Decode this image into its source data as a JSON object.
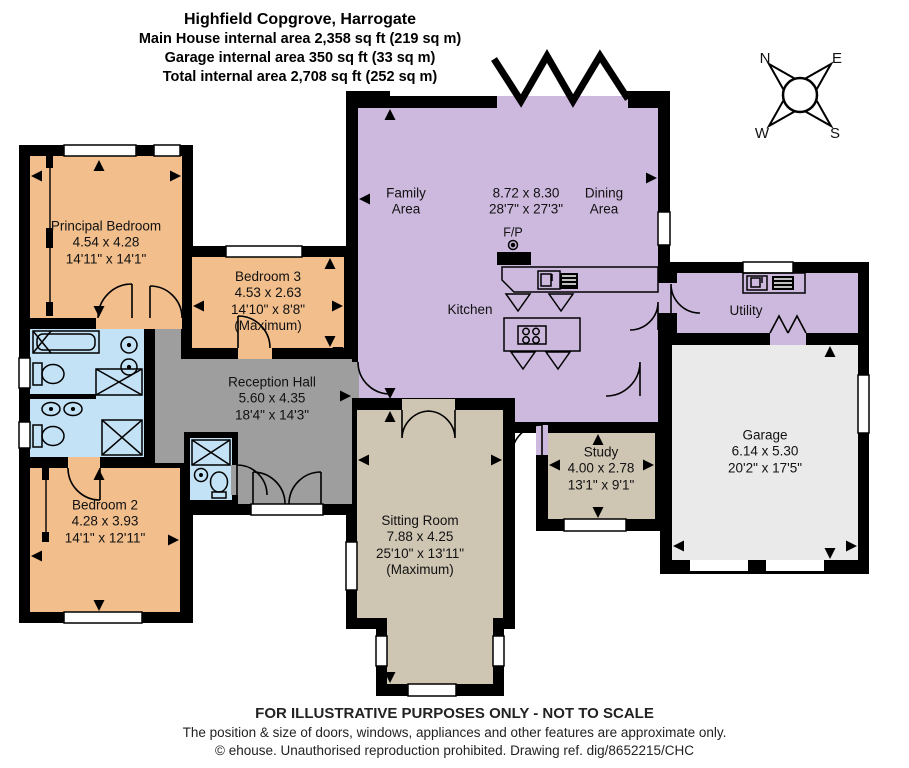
{
  "header": {
    "title": "Highfield Copgrove, Harrogate",
    "area_lines": [
      "Main House internal area 2,358 sq ft (219 sq m)",
      "Garage internal area 350 sq ft (33 sq m)",
      "Total internal area 2,708 sq ft (252 sq m)"
    ]
  },
  "compass": {
    "north": "N",
    "east": "E",
    "south": "S",
    "west": "W"
  },
  "rooms": {
    "principal_bedroom": {
      "name": "Principal Bedroom",
      "metric": "4.54 x 4.28",
      "imperial": "14'11\" x 14'1\""
    },
    "bedroom_3": {
      "name": "Bedroom 3",
      "metric": "4.53 x 2.63",
      "imperial": "14'10\" x 8'8\"",
      "note": "(Maximum)"
    },
    "bedroom_2": {
      "name": "Bedroom 2",
      "metric": "4.28 x 3.93",
      "imperial": "14'1\" x 12'11\""
    },
    "reception_hall": {
      "name": "Reception Hall",
      "metric": "5.60 x 4.35",
      "imperial": "18'4\" x 14'3\""
    },
    "open_plan": {
      "family_label": "Family Area",
      "dining_label": "Dining Area",
      "kitchen_label": "Kitchen",
      "fireplace_label": "F/P",
      "metric": "8.72 x 8.30",
      "imperial": "28'7\" x 27'3\""
    },
    "utility": {
      "name": "Utility"
    },
    "garage": {
      "name": "Garage",
      "metric": "6.14 x 5.30",
      "imperial": "20'2\" x 17'5\""
    },
    "study": {
      "name": "Study",
      "metric": "4.00 x 2.78",
      "imperial": "13'1\" x 9'1\""
    },
    "sitting_room": {
      "name": "Sitting Room",
      "metric": "7.88 x 4.25",
      "imperial": "25'10\" x 13'11\"",
      "note": "(Maximum)"
    }
  },
  "footer": {
    "line1": "FOR ILLUSTRATIVE PURPOSES ONLY - NOT TO SCALE",
    "line2": "The position & size of doors, windows, appliances and other features are approximate only.",
    "line3": "© ehouse. Unauthorised reproduction prohibited. Drawing ref. dig/8652215/CHC"
  },
  "colors": {
    "bedroom": "#F2BE8C",
    "living": "#CDB9DE",
    "hall": "#9E9E9E",
    "lounge": "#CEC5B3",
    "garage": "#EAEAEA",
    "bath": "#C3E2F5",
    "wall": "#000000",
    "window": "#FFFFFF"
  }
}
